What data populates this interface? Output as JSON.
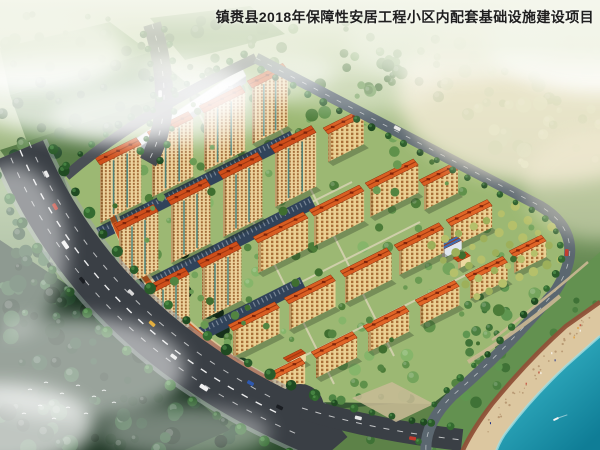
{
  "title": "镇赉县2018年保障性安居工程小区内配套基础设施建设项目",
  "scene": {
    "colors": {
      "title_color": "#1f1f1f",
      "facade": "#ecd29b",
      "window": "#a26b36",
      "facade_mid": "#ead092",
      "window_mid": "#aa7038",
      "roof_tall": "#cf4f1b",
      "roof_mid": "#d95e22",
      "roof_short": "#e06527",
      "roof_kind": "#c84a16",
      "roof_blue": "#3f6db0",
      "roof_edge": "#8d2c0b",
      "roof_box": "#7e230a",
      "asphalt": "#3a3f45",
      "sidewalk": "#9aa0a6",
      "lane": "#ffffff",
      "site_green": "#9cb873",
      "forest_dark": "#1c3422",
      "parking": "#31435a",
      "shops_roof": "#cf571e",
      "glass": "#4e7d8e",
      "white_roof": "#eff1f3",
      "white_side": "#9aa1a9",
      "sand": "#dcc7a0",
      "shore_edge": "#8f5138",
      "water_shallow": "#62c6cf",
      "water_mid": "#2ba4b8",
      "water_deep": "#0f7d96",
      "mist": "#ffffff",
      "mist_warm": "#f7edd8",
      "path_tan": "#cbb893",
      "orchard_a": "#b5c06a",
      "orchard_b": "#9db05a"
    },
    "site_outline": "M64,178 Q140,112 256,58 L540,206 Q590,236 556,290 Q508,348 432,404 L312,402 Q118,340 64,178 Z",
    "roads": {
      "highway": {
        "d": "M20,150 Q100,340 315,430",
        "width": 50
      },
      "lanes": [
        "M10.9,157.8 Q90.9,347.8 305.9,437.8",
        "M29.1,142.2 Q109.1,332.2 324.1,422.2"
      ],
      "spur": {
        "d": "M152,24 Q178,108 148,162",
        "width": 18
      },
      "nw": {
        "d": "M66,176 Q140,112 256,58",
        "width": 10
      },
      "ring": {
        "d": "M256,58 L540,206 Q590,236 556,290 Q508,348 452,396 Q424,424 426,452",
        "width": 11
      },
      "branch": {
        "d": "M302,408 Q372,430 462,440",
        "width": 22
      },
      "stub": {
        "d": "M306,424 L330,452",
        "width": 46
      },
      "hedge_ne": "M262,68 L534,210"
    },
    "buildings": [
      [
        100,
        165,
        46,
        58,
        "t"
      ],
      [
        152,
        139,
        46,
        58,
        "t"
      ],
      [
        204,
        113,
        46,
        58,
        "t"
      ],
      [
        252,
        88,
        40,
        56,
        "t"
      ],
      [
        119,
        231,
        44,
        58,
        "t"
      ],
      [
        171,
        205,
        44,
        58,
        "t"
      ],
      [
        223,
        179,
        44,
        58,
        "t"
      ],
      [
        275,
        153,
        46,
        54,
        "t"
      ],
      [
        328,
        134,
        40,
        28,
        "m"
      ],
      [
        150,
        294,
        44,
        52,
        "t"
      ],
      [
        202,
        268,
        44,
        52,
        "t"
      ],
      [
        258,
        243,
        56,
        30,
        "m"
      ],
      [
        314,
        216,
        56,
        30,
        "m"
      ],
      [
        370,
        189,
        54,
        28,
        "m"
      ],
      [
        424,
        186,
        38,
        24,
        "m"
      ],
      [
        233,
        331,
        52,
        26,
        "m"
      ],
      [
        289,
        304,
        52,
        26,
        "m"
      ],
      [
        345,
        277,
        52,
        26,
        "m"
      ],
      [
        399,
        251,
        50,
        24,
        "m"
      ],
      [
        451,
        226,
        46,
        22,
        "s"
      ],
      [
        264,
        384,
        46,
        20,
        "s"
      ],
      [
        316,
        358,
        46,
        20,
        "s"
      ],
      [
        368,
        332,
        46,
        20,
        "s"
      ],
      [
        420,
        306,
        44,
        19,
        "s"
      ],
      [
        470,
        281,
        42,
        18,
        "s"
      ],
      [
        514,
        257,
        36,
        16,
        "s"
      ],
      [
        288,
        362,
        20,
        8,
        "k"
      ],
      [
        442,
        250,
        22,
        9,
        "b"
      ],
      [
        458,
        262,
        14,
        7,
        "k"
      ]
    ],
    "white_building": {
      "roof": [
        [
          108,
          168
        ],
        [
          246,
          76
        ],
        [
          242,
          68
        ],
        [
          104,
          160
        ]
      ],
      "facade": [
        [
          108,
          168
        ],
        [
          246,
          76
        ],
        [
          246,
          83
        ],
        [
          108,
          175
        ]
      ]
    },
    "shops": {
      "base": "M110,205 Q150,330 300,396",
      "roof": "M107,202 Q147,327 297,393",
      "glass": "M112,208 Q152,333 302,398"
    },
    "parking": [
      [
        [
          96,
          228
        ],
        [
          290,
          131
        ],
        [
          296,
          143
        ],
        [
          102,
          240
        ]
      ],
      [
        [
          121,
          292
        ],
        [
          310,
          196
        ],
        [
          316,
          208
        ],
        [
          127,
          304
        ]
      ],
      [
        [
          152,
          351
        ],
        [
          300,
          277
        ],
        [
          306,
          289
        ],
        [
          158,
          363
        ]
      ]
    ],
    "inner_paths": [
      "M100,232 L300,132",
      "M124,296 L352,182",
      "M155,356 L420,222",
      "M200,408 L480,268",
      "M200,115 L334,384",
      "M260,88 L394,356"
    ],
    "field_quads": [
      {
        "pts": [
          [
            0,
            48
          ],
          [
            110,
            22
          ],
          [
            150,
            52
          ],
          [
            10,
            95
          ]
        ],
        "fill": "#7da267"
      },
      {
        "pts": [
          [
            10,
            95
          ],
          [
            150,
            52
          ],
          [
            190,
            86
          ],
          [
            30,
            150
          ]
        ],
        "fill": "#6a8f56"
      },
      {
        "pts": [
          [
            0,
            150
          ],
          [
            170,
            95
          ],
          [
            210,
            130
          ],
          [
            40,
            205
          ]
        ],
        "fill": "#587c47"
      },
      {
        "pts": [
          [
            150,
            18
          ],
          [
            250,
            6
          ],
          [
            285,
            34
          ],
          [
            185,
            60
          ]
        ],
        "fill": "#74995e"
      }
    ],
    "forest_poly": [
      [
        0,
        240
      ],
      [
        90,
        300
      ],
      [
        230,
        430
      ],
      [
        180,
        452
      ],
      [
        0,
        452
      ]
    ],
    "shore_strip": [
      [
        556,
        290
      ],
      [
        508,
        348
      ],
      [
        452,
        396
      ],
      [
        424,
        424
      ],
      [
        426,
        452
      ],
      [
        470,
        452
      ],
      [
        540,
        360
      ],
      [
        600,
        300
      ],
      [
        600,
        252
      ]
    ],
    "south_park": [
      [
        300,
        412
      ],
      [
        436,
        400
      ],
      [
        426,
        452
      ],
      [
        316,
        452
      ]
    ],
    "plaza": [
      [
        352,
        398
      ],
      [
        392,
        382
      ],
      [
        434,
        404
      ],
      [
        396,
        422
      ]
    ],
    "beach": {
      "sand": "M600,302 L566,326 Q528,360 492,404 Q472,430 462,452 L496,452 Q500,440 508,430 Q532,398 566,366 L600,336 Z",
      "edge": "M600,302 L566,326 Q528,360 492,404 Q472,430 462,452",
      "water": "M600,336 L566,366 Q532,398 508,430 Q500,440 496,452 L600,452 Z",
      "rim": "M600,336 L566,366 Q532,398 508,430 Q500,440 496,452",
      "shore_mid": "M592,318 Q540,362 486,430",
      "boat": [
        556,
        419
      ]
    },
    "pools": {
      "deck": [
        536,
        372,
        9
      ],
      "a": [
        532,
        369,
        4.5,
        3
      ],
      "b": [
        543,
        376,
        3.5,
        2.5
      ],
      "umb": [
        [
          528,
          375,
          "#d04040"
        ],
        [
          547,
          370,
          "#e6e6e6"
        ]
      ]
    },
    "park_paths": [
      "M560,296 Q520,330 468,362",
      "M588,262 Q544,300 492,340"
    ],
    "orchard": {
      "x0": 432,
      "y0": 246,
      "rows": 5,
      "cols": 9
    },
    "tree_zones": [
      {
        "x": 0,
        "y": 14,
        "w": 240,
        "h": 135,
        "n": 55,
        "pal": [
          "#55794a",
          "#69905a",
          "#46683d"
        ],
        "rmin": 2.5,
        "rmax": 7,
        "clip": false
      },
      {
        "x": 245,
        "y": 18,
        "w": 200,
        "h": 80,
        "n": 45,
        "pal": [
          "#6d9258",
          "#7fa667",
          "#5b8049"
        ],
        "rmin": 2.5,
        "rmax": 6.5,
        "clip": false
      },
      {
        "x": 440,
        "y": 15,
        "w": 160,
        "h": 150,
        "n": 60,
        "pal": [
          "#a3c28b",
          "#b7d29e",
          "#8fb277"
        ],
        "rmin": 3,
        "rmax": 8,
        "clip": false
      },
      {
        "x": 0,
        "y": 150,
        "w": 70,
        "h": 170,
        "n": 35,
        "pal": [
          "#2c5232",
          "#234427",
          "#38663c"
        ],
        "rmin": 3,
        "rmax": 7,
        "clip": false
      },
      {
        "x": 0,
        "y": 250,
        "w": 250,
        "h": 200,
        "n": 110,
        "pal": [
          "#15301b",
          "#1e4026",
          "#2a5430",
          "#0f2414"
        ],
        "rmin": 3,
        "rmax": 9,
        "clip": false
      },
      {
        "x": 300,
        "y": 395,
        "w": 140,
        "h": 55,
        "n": 18,
        "pal": [
          "#3f7236",
          "#518744"
        ],
        "rmin": 2.5,
        "rmax": 5,
        "clip": false
      },
      {
        "x": 460,
        "y": 280,
        "w": 140,
        "h": 130,
        "n": 40,
        "pal": [
          "#4c8040",
          "#5f9650",
          "#3f7236"
        ],
        "rmin": 2.5,
        "rmax": 6,
        "clip": false
      },
      {
        "x": 100,
        "y": 70,
        "w": 440,
        "h": 330,
        "n": 130,
        "pal": [
          "#4c7c38",
          "#5f914a",
          "#74a45c",
          "#86b56a"
        ],
        "rmin": 2.5,
        "rmax": 6.5,
        "clip": true
      }
    ],
    "site_scatter2": {
      "n": 55,
      "pal": [
        "#3f6e2f",
        "#538441",
        "#6a9a52"
      ],
      "rmin": 2,
      "rmax": 4.5
    },
    "car_colors": [
      "#e8e8e8",
      "#c23b2e",
      "#2e59b0",
      "#1a1d22",
      "#d8d8d8",
      "#e0a62a"
    ],
    "birds": [
      [
        30,
        390
      ],
      [
        46,
        383
      ],
      [
        62,
        394
      ],
      [
        78,
        386
      ],
      [
        94,
        397
      ],
      [
        40,
        406
      ],
      [
        68,
        408
      ],
      [
        86,
        414
      ],
      [
        54,
        419
      ],
      [
        104,
        391
      ],
      [
        114,
        403
      ],
      [
        24,
        414
      ]
    ],
    "mist": [
      [
        105,
        92,
        150,
        46,
        0.75,
        0
      ],
      [
        240,
        72,
        95,
        30,
        0.5,
        0
      ],
      [
        30,
        50,
        95,
        42,
        0.85,
        0
      ],
      [
        160,
        115,
        110,
        32,
        0.55,
        0
      ],
      [
        12,
        250,
        55,
        85,
        0.5,
        0
      ],
      [
        70,
        368,
        115,
        52,
        0.55,
        0
      ],
      [
        0,
        425,
        95,
        42,
        0.72,
        0
      ],
      [
        185,
        432,
        85,
        26,
        0.4,
        0
      ],
      [
        548,
        92,
        150,
        92,
        0.78,
        1
      ],
      [
        600,
        38,
        115,
        55,
        0.85,
        0
      ],
      [
        452,
        42,
        105,
        38,
        0.5,
        0
      ],
      [
        598,
        185,
        75,
        55,
        0.45,
        1
      ],
      [
        345,
        82,
        100,
        30,
        0.3,
        0
      ]
    ]
  }
}
